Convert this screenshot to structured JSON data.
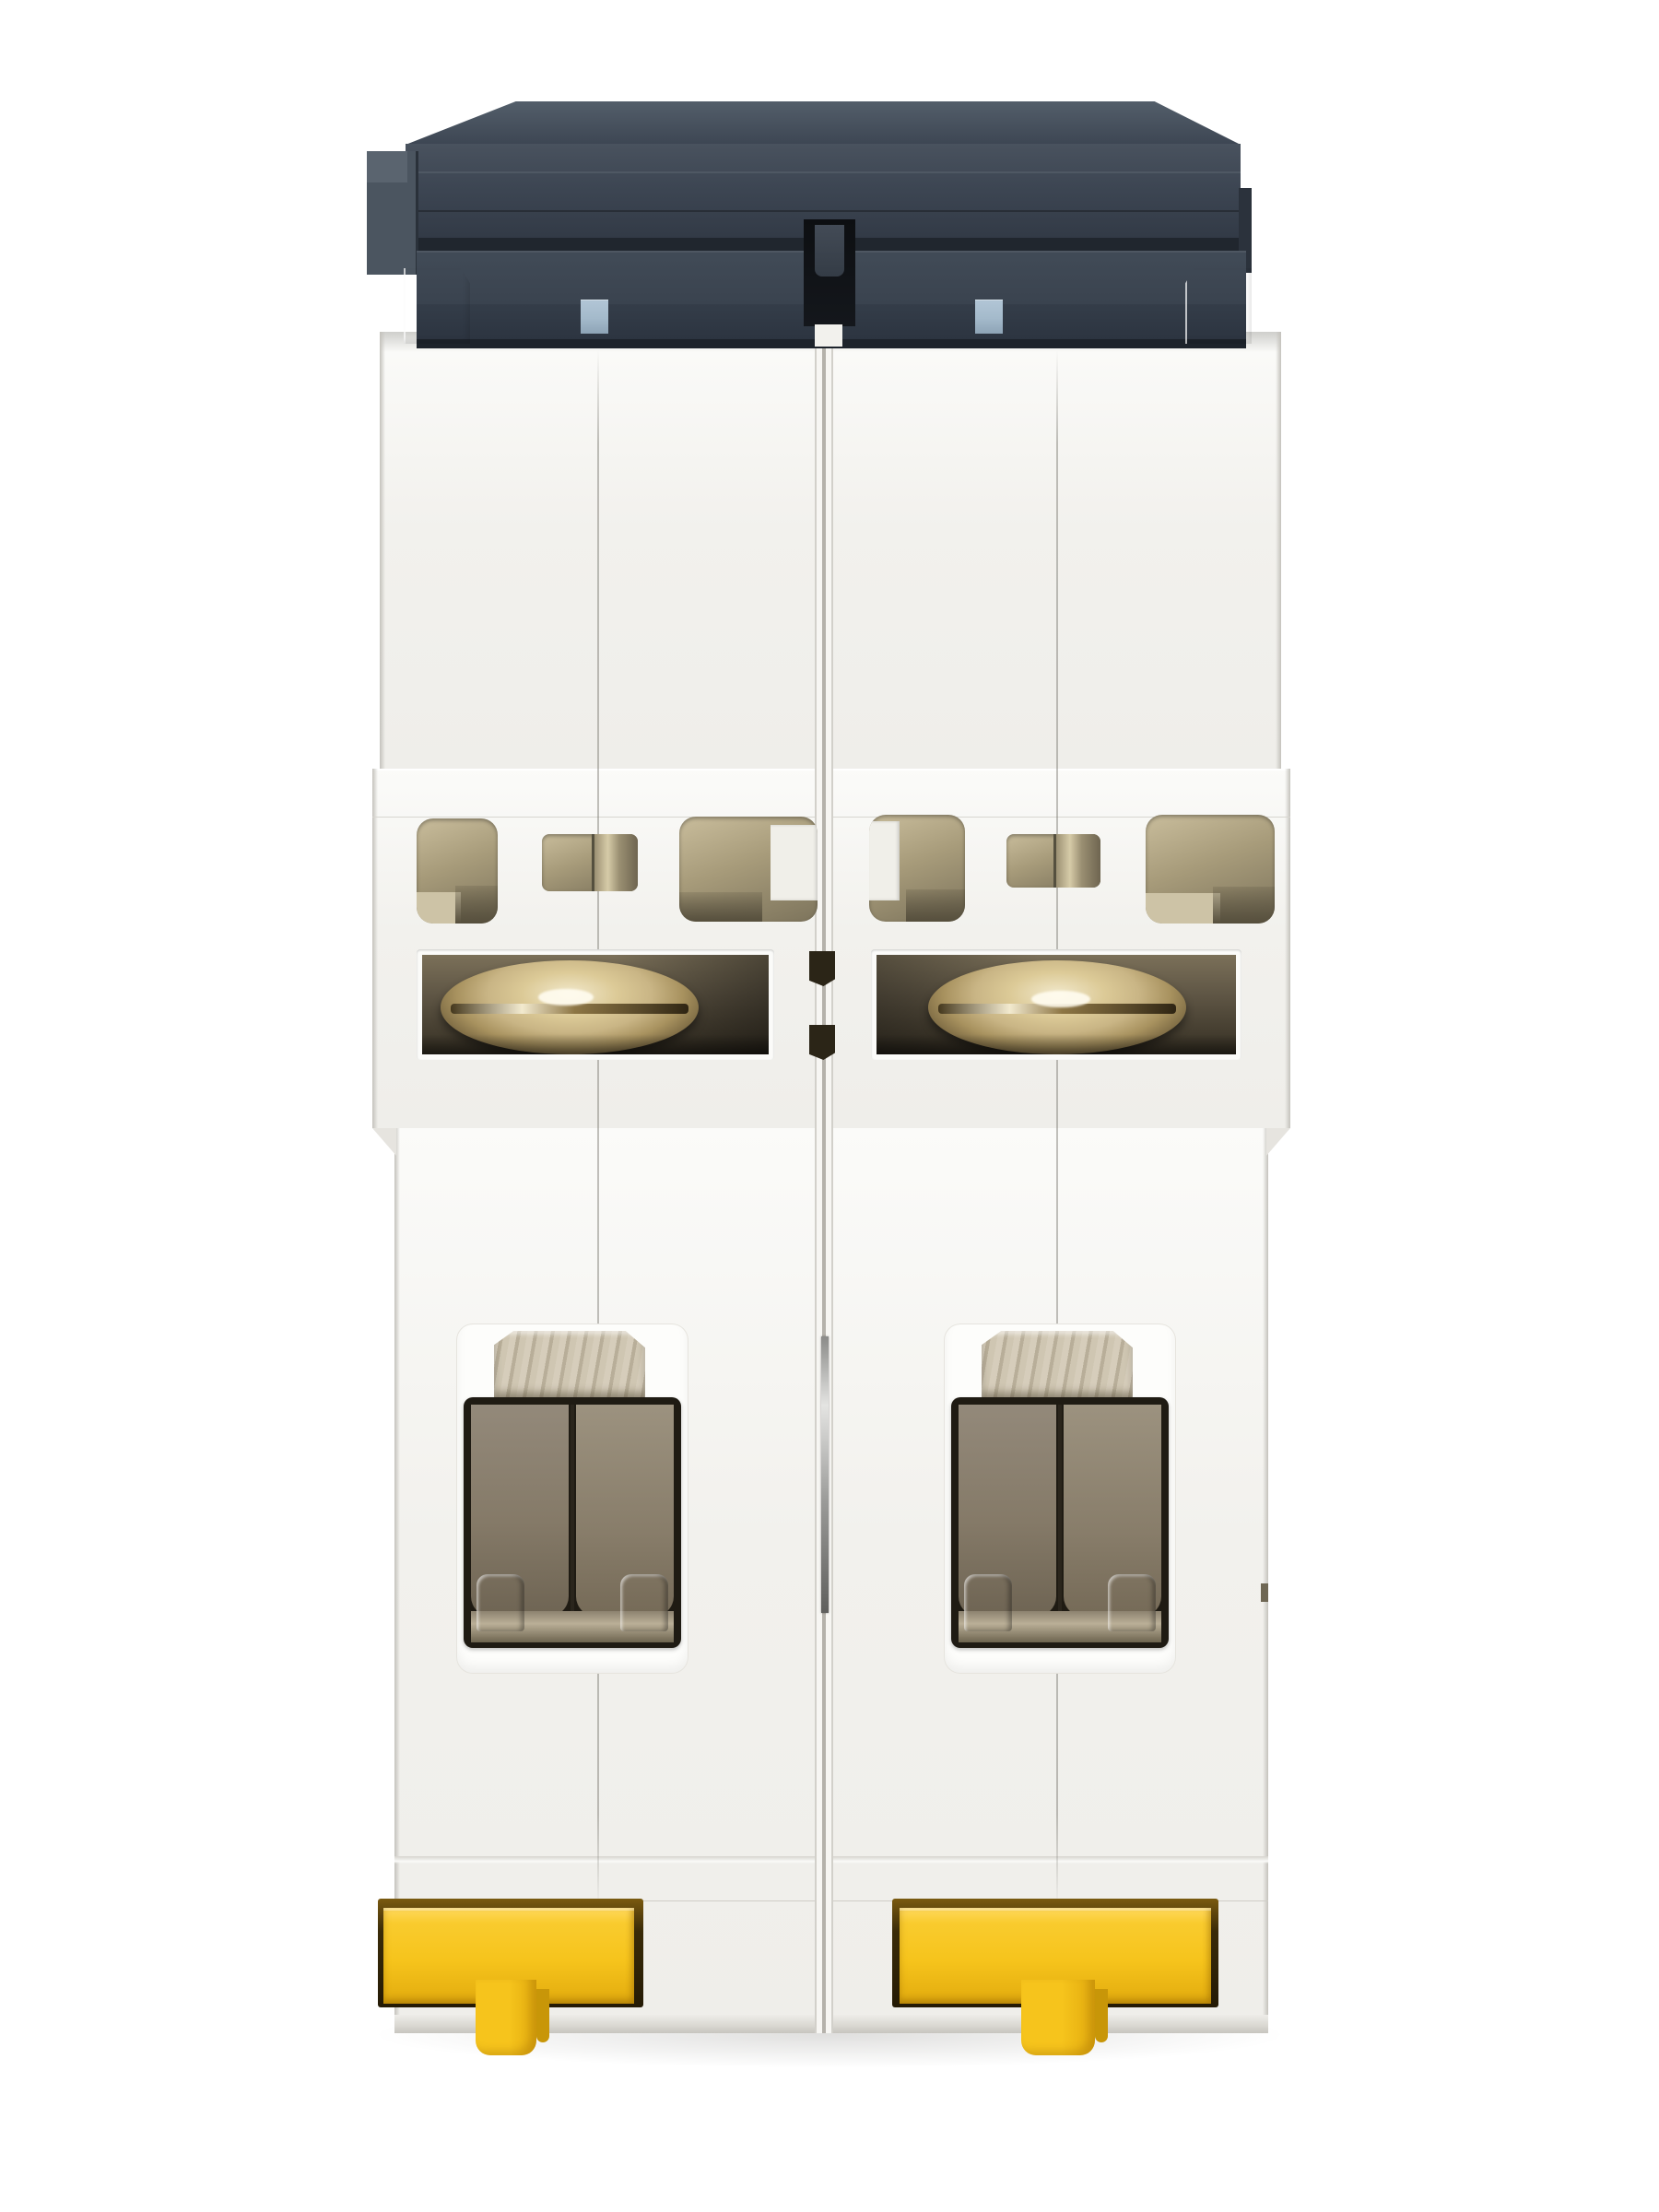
{
  "scene": {
    "type": "product-photo",
    "subject": "Two-pole DIN-rail miniature circuit breaker photographed from the DIN-rail (bottom) side",
    "background": "plain white studio background",
    "pole_count": 2,
    "visible_text": ""
  },
  "parts": {
    "device": "2-pole miniature circuit breaker, bottom view",
    "toggle_assembly": "Dark gray toggle handle assembly",
    "toggle_indicator": "Blue-gray toggle position indicator window",
    "toggle_gap": "Dark gap between the two pole handles",
    "corner_post": "White housing corner post",
    "upper_housing": "Upper housing shell",
    "vented_band": "Vented mid band of housing",
    "vent": "Ventilation opening showing khaki interior",
    "screw_window": "Terminal-screw inspection window",
    "screw": "Brass combination-head terminal screw",
    "center_latch": "Inter-pole latch tab",
    "lower_housing": "Lower housing shell",
    "terminal": "Box-clamp wire terminal opening",
    "terminal_clamp": "Galvanized terminal clamp plate",
    "terminal_cavity": "Smoky wire-entry cavity with clamp hooks",
    "module_seam": "Half-shell seam of pole module",
    "center_seam": "Seam channel between pole modules",
    "rivet_pin": "Metal assembly pin in center channel",
    "din_clip": "Yellow DIN-rail mounting clip",
    "clip_tab": "Yellow DIN-clip release tab",
    "contact_shadow": "Soft contact shadow on background"
  },
  "palette": {
    "bg": "#ffffff",
    "plastic": "#f2f1ed",
    "plastic_hi": "#fbfbf9",
    "plastic_lo": "#dedcd6",
    "plastic_deep": "#c4c2bc",
    "cap_top": "#535e6a",
    "cap_face": "#3d4653",
    "cap_mid": "#3a434f",
    "cap_low": "#343d49",
    "cap_shadow": "#20262e",
    "cap_black": "#14171c",
    "cap_end": "#4b5560",
    "indicator_blue": "#a4bacb",
    "vent_hi": "#c9bd9c",
    "vent_mid": "#a79b7a",
    "vent_lo": "#564f3d",
    "win_hi": "#7b7059",
    "win_lo": "#352f23",
    "brass_hi": "#f2e9cc",
    "brass_mid": "#c9b585",
    "brass_lo": "#6b5a38",
    "metal_hi": "#d6cdbb",
    "metal_mid": "#b1a791",
    "metal_lo": "#6f6754",
    "smoke_hi": "#9c927f",
    "smoke_lo": "#6e6453",
    "yellow": "#f6c41c",
    "yellow_hi": "#ffd95e",
    "yellow_lo": "#e2ab0e",
    "amber": "#c89608",
    "clip_frame_dark": "#241a05"
  }
}
